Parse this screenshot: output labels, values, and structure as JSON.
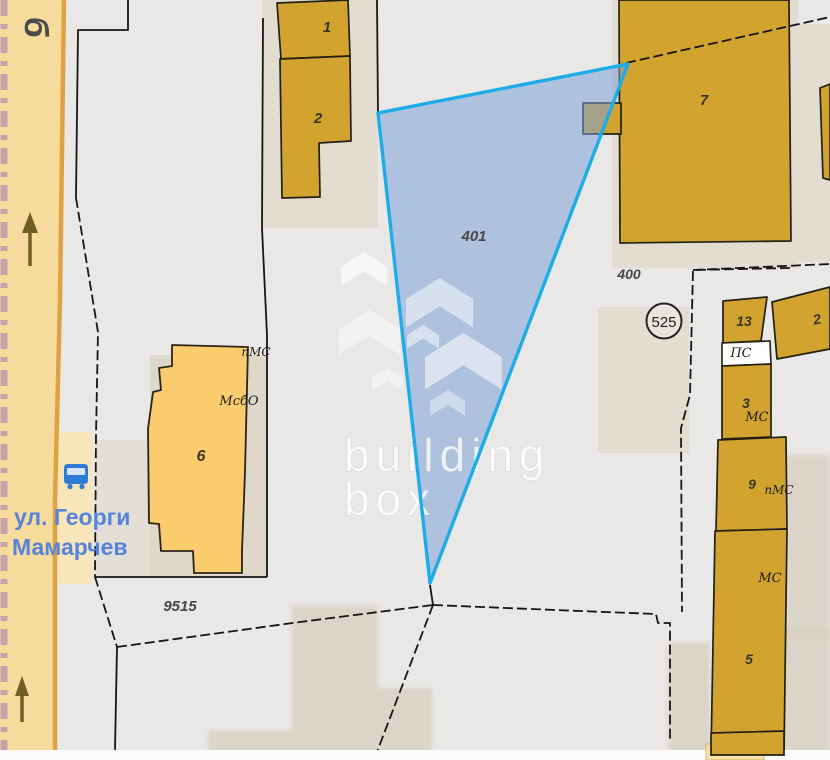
{
  "app": {
    "title": "cadastral map viewer"
  },
  "watermark": {
    "line1": "building",
    "line2": "box"
  },
  "road": {
    "street_char": "б",
    "name_line1": "ул. Георги",
    "name_line2": "Мамарчев"
  },
  "parcels": {
    "highlighted": "401",
    "p400": "400",
    "p9515": "9515",
    "point": "525"
  },
  "buildings": {
    "b1": "1",
    "b2": "2",
    "b7": "7",
    "b13": "13",
    "b2r": "2",
    "b3": "3",
    "b3_type": "МС",
    "b9": "9",
    "b9_type": "пМС",
    "b5": "5",
    "b5_type": "МС",
    "b6": "6",
    "b6_type1": "пМС",
    "b6_type2": "МсбО",
    "ps": "ПС"
  },
  "colors": {
    "highlight_border": "#1CADE8",
    "highlight_fill": "#AFC4E4",
    "building": "#D2A42F",
    "building_light": "#FACC6E",
    "road": "#F6DB9C",
    "street_text": "#5584DA"
  }
}
